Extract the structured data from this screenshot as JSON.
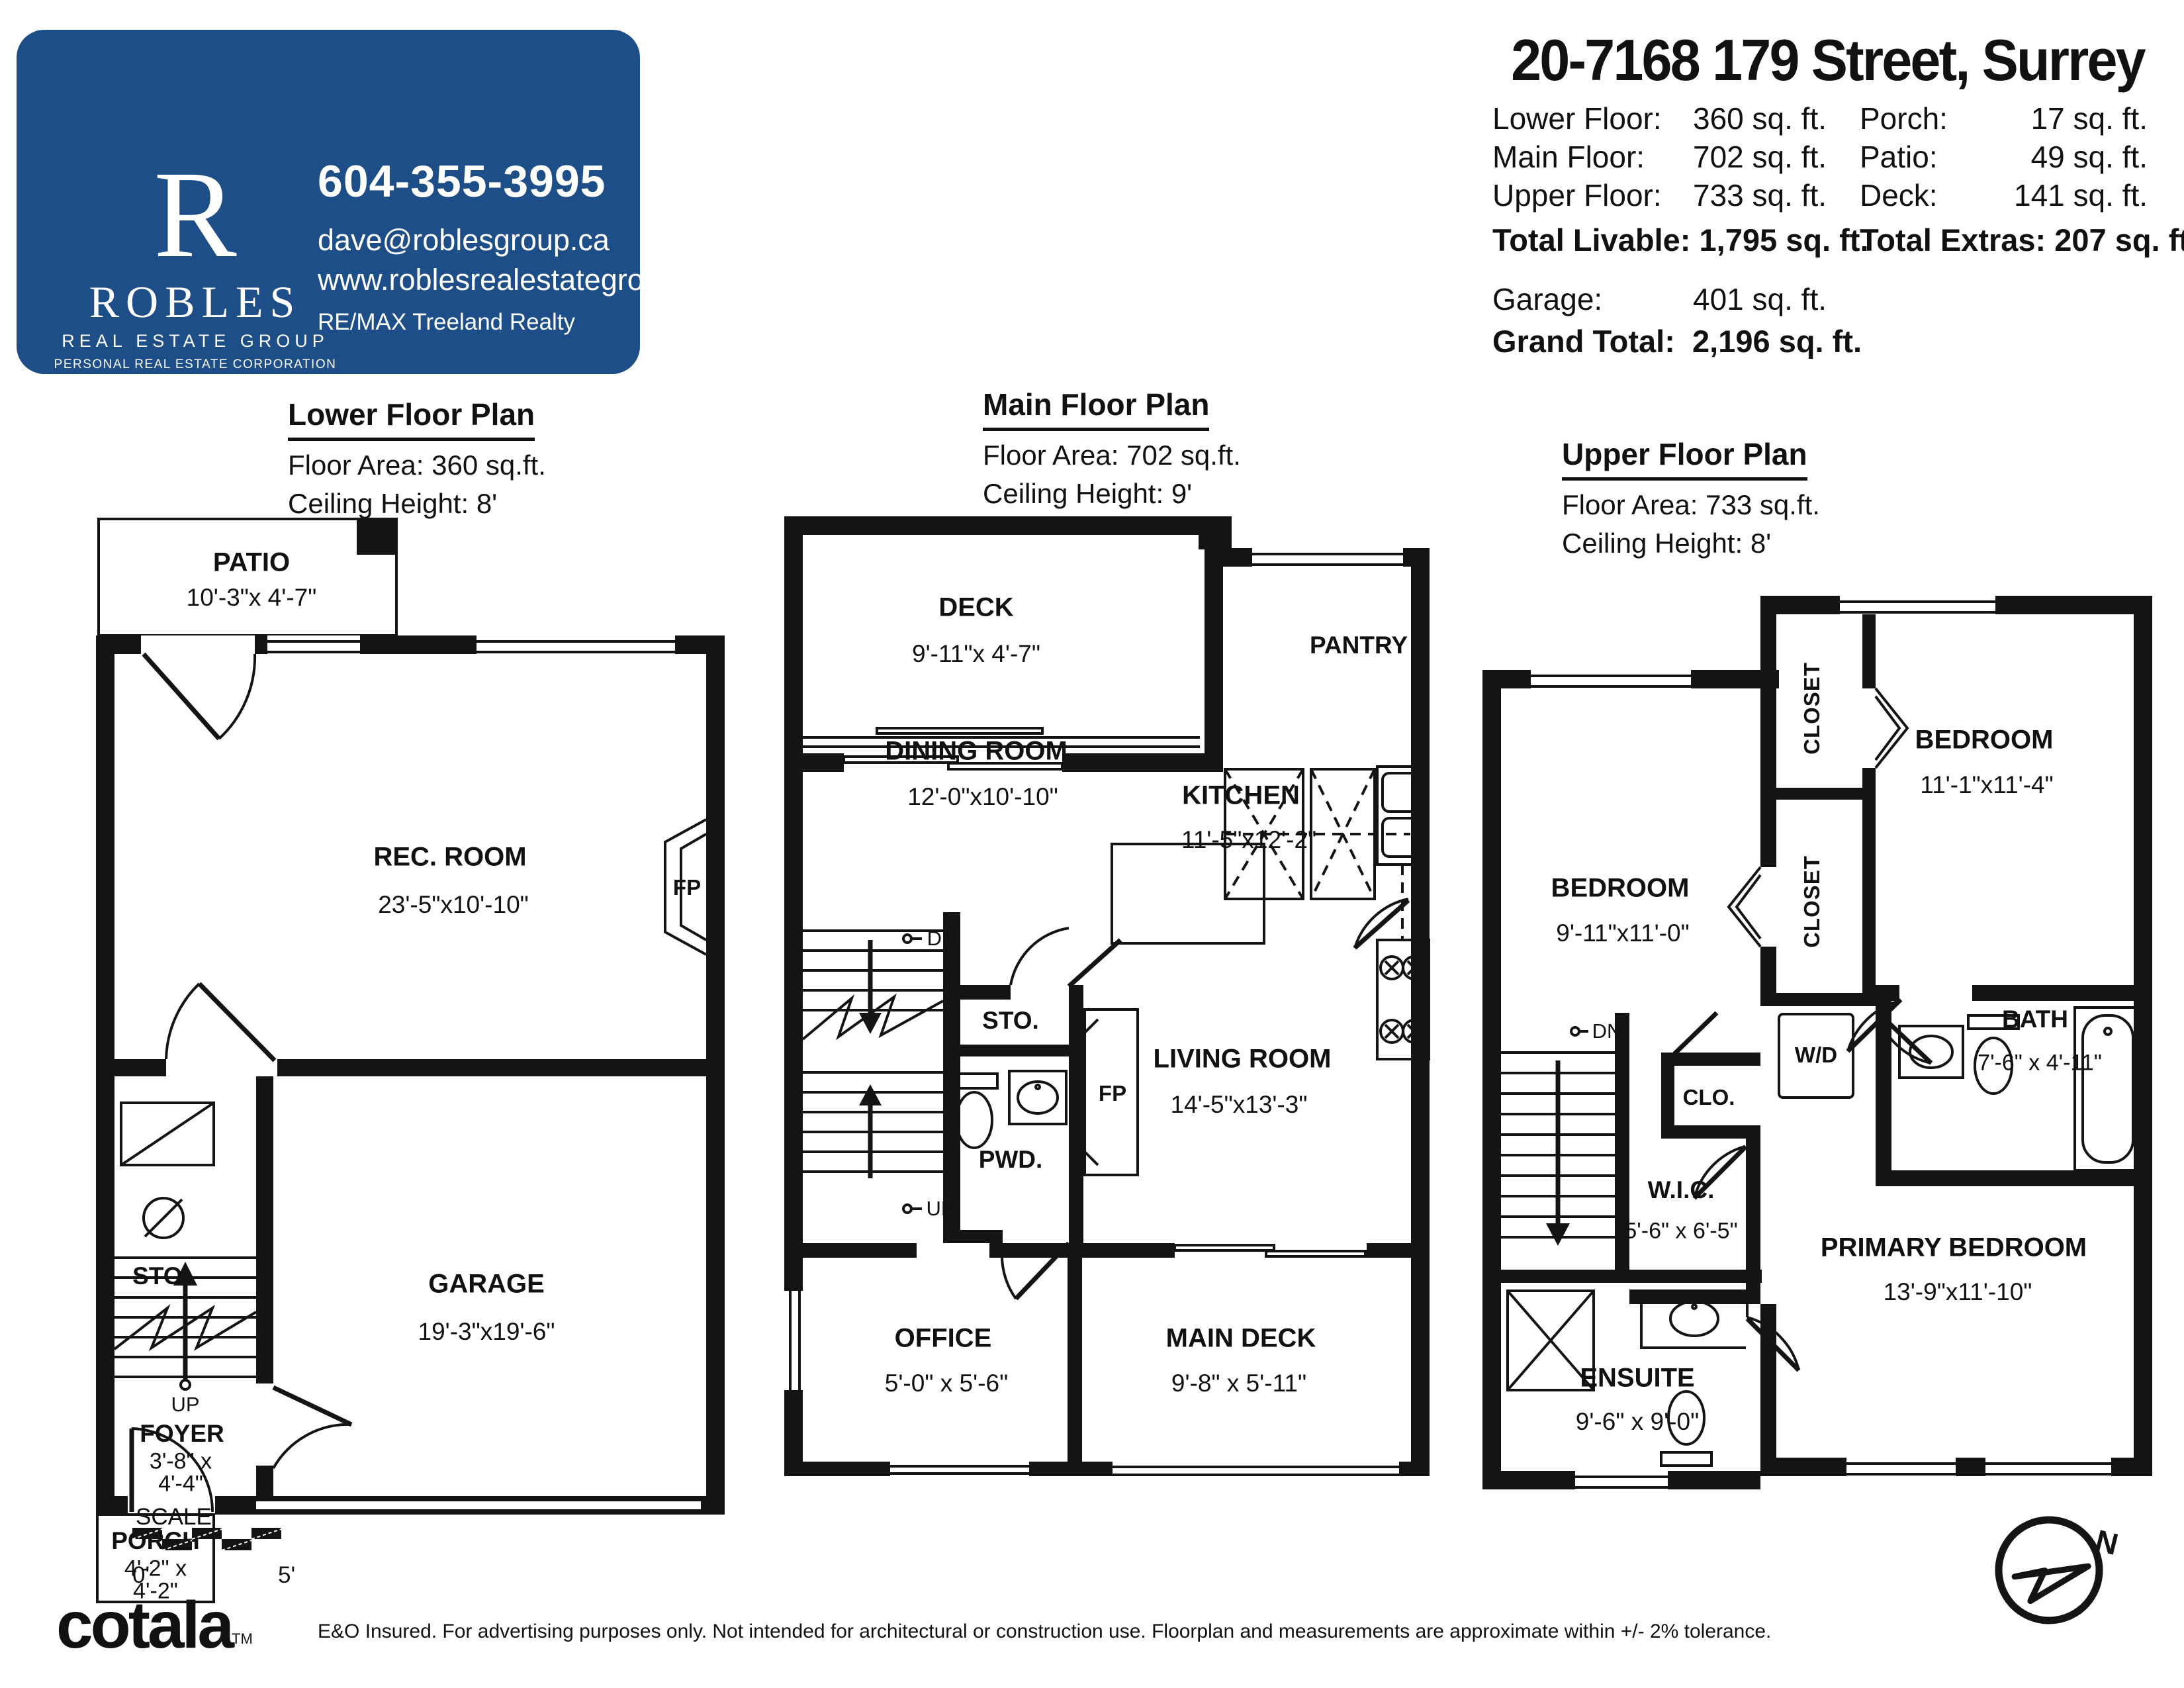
{
  "agent_card": {
    "bg_color": "#1d4e87",
    "logo_letter": "R",
    "logo_name": "ROBLES",
    "logo_tagline": "REAL ESTATE GROUP",
    "logo_subtext": "PERSONAL REAL ESTATE CORPORATION",
    "phone": "604-355-3995",
    "email": "dave@roblesgroup.ca",
    "website": "www.roblesrealestategroup.ca",
    "brokerage": "RE/MAX Treeland Realty"
  },
  "header": {
    "address": "20-7168 179 Street, Surrey",
    "areas_left": [
      {
        "label": "Lower Floor:",
        "value": "360 sq. ft."
      },
      {
        "label": "Main Floor:",
        "value": "702 sq. ft."
      },
      {
        "label": "Upper Floor:",
        "value": "733 sq. ft."
      }
    ],
    "areas_right": [
      {
        "label": "Porch:",
        "value": "17 sq. ft."
      },
      {
        "label": "Patio:",
        "value": "49 sq. ft."
      },
      {
        "label": "Deck:",
        "value": "141 sq. ft."
      }
    ],
    "total_livable_label": "Total Livable:",
    "total_livable_value": "1,795 sq. ft.",
    "total_extras_label": "Total Extras:",
    "total_extras_value": "207 sq. ft.",
    "garage_label": "Garage:",
    "garage_value": "401 sq. ft.",
    "grand_total_label": "Grand Total:",
    "grand_total_value": "2,196 sq. ft."
  },
  "plans": {
    "lower": {
      "title": "Lower Floor Plan",
      "area": "Floor Area: 360 sq.ft.",
      "ceiling": "Ceiling Height: 8'",
      "rooms": {
        "patio_name": "PATIO",
        "patio_dims": "10'-3\"x 4'-7\"",
        "rec_name": "REC. ROOM",
        "rec_dims": "23'-5\"x10'-10\"",
        "fp": "FP",
        "sto": "STO.",
        "up": "UP",
        "garage_name": "GARAGE",
        "garage_dims": "19'-3\"x19'-6\"",
        "foyer_name": "FOYER",
        "foyer_dims1": "3'-8\" x",
        "foyer_dims2": "4'-4\"",
        "porch_name": "PORCH",
        "porch_dims1": "4'-2\" x",
        "porch_dims2": "4'-2\""
      }
    },
    "main": {
      "title": "Main Floor Plan",
      "area": "Floor Area: 702 sq.ft.",
      "ceiling": "Ceiling Height: 9'",
      "rooms": {
        "deck_name": "DECK",
        "deck_dims": "9'-11\"x 4'-7\"",
        "pantry": "PANTRY",
        "kitchen_name": "KITCHEN",
        "kitchen_dims": "11'-5\"x12'-2\"",
        "dining_name": "DINING ROOM",
        "dining_dims": "12'-0\"x10'-10\"",
        "dn": "DN",
        "sto": "STO.",
        "pwd": "PWD.",
        "fp": "FP",
        "up": "UP",
        "living_name": "LIVING ROOM",
        "living_dims": "14'-5\"x13'-3\"",
        "office_name": "OFFICE",
        "office_dims": "5'-0\" x 5'-6\"",
        "maindeck_name": "MAIN DECK",
        "maindeck_dims": "9'-8\" x 5'-11\""
      }
    },
    "upper": {
      "title": "Upper Floor Plan",
      "area": "Floor Area: 733 sq.ft.",
      "ceiling": "Ceiling Height: 8'",
      "rooms": {
        "closet1": "CLOSET",
        "closet2": "CLOSET",
        "bed1_name": "BEDROOM",
        "bed1_dims": "11'-1\"x11'-4\"",
        "bed2_name": "BEDROOM",
        "bed2_dims": "9'-11\"x11'-0\"",
        "wd": "W/D",
        "dn": "DN",
        "clo": "CLO.",
        "bath_name": "BATH",
        "bath_dims": "7'-6\" x 4'-11\"",
        "wic_name": "W.I.C.",
        "wic_dims": "5'-6\" x 6'-5\"",
        "primary_name": "PRIMARY BEDROOM",
        "primary_dims": "13'-9\"x11'-10\"",
        "ensuite_name": "ENSUITE",
        "ensuite_dims": "9'-6\" x 9'-0\""
      }
    }
  },
  "footer": {
    "scale_label": "SCALE",
    "scale_start": "0'",
    "scale_end": "5'",
    "brand": "cotala",
    "brand_tm": "TM",
    "disclaimer": "E&O Insured. For advertising purposes only. Not intended for architectural or construction use. Floorplan and measurements are approximate within +/- 2% tolerance.",
    "compass_n": "N"
  }
}
